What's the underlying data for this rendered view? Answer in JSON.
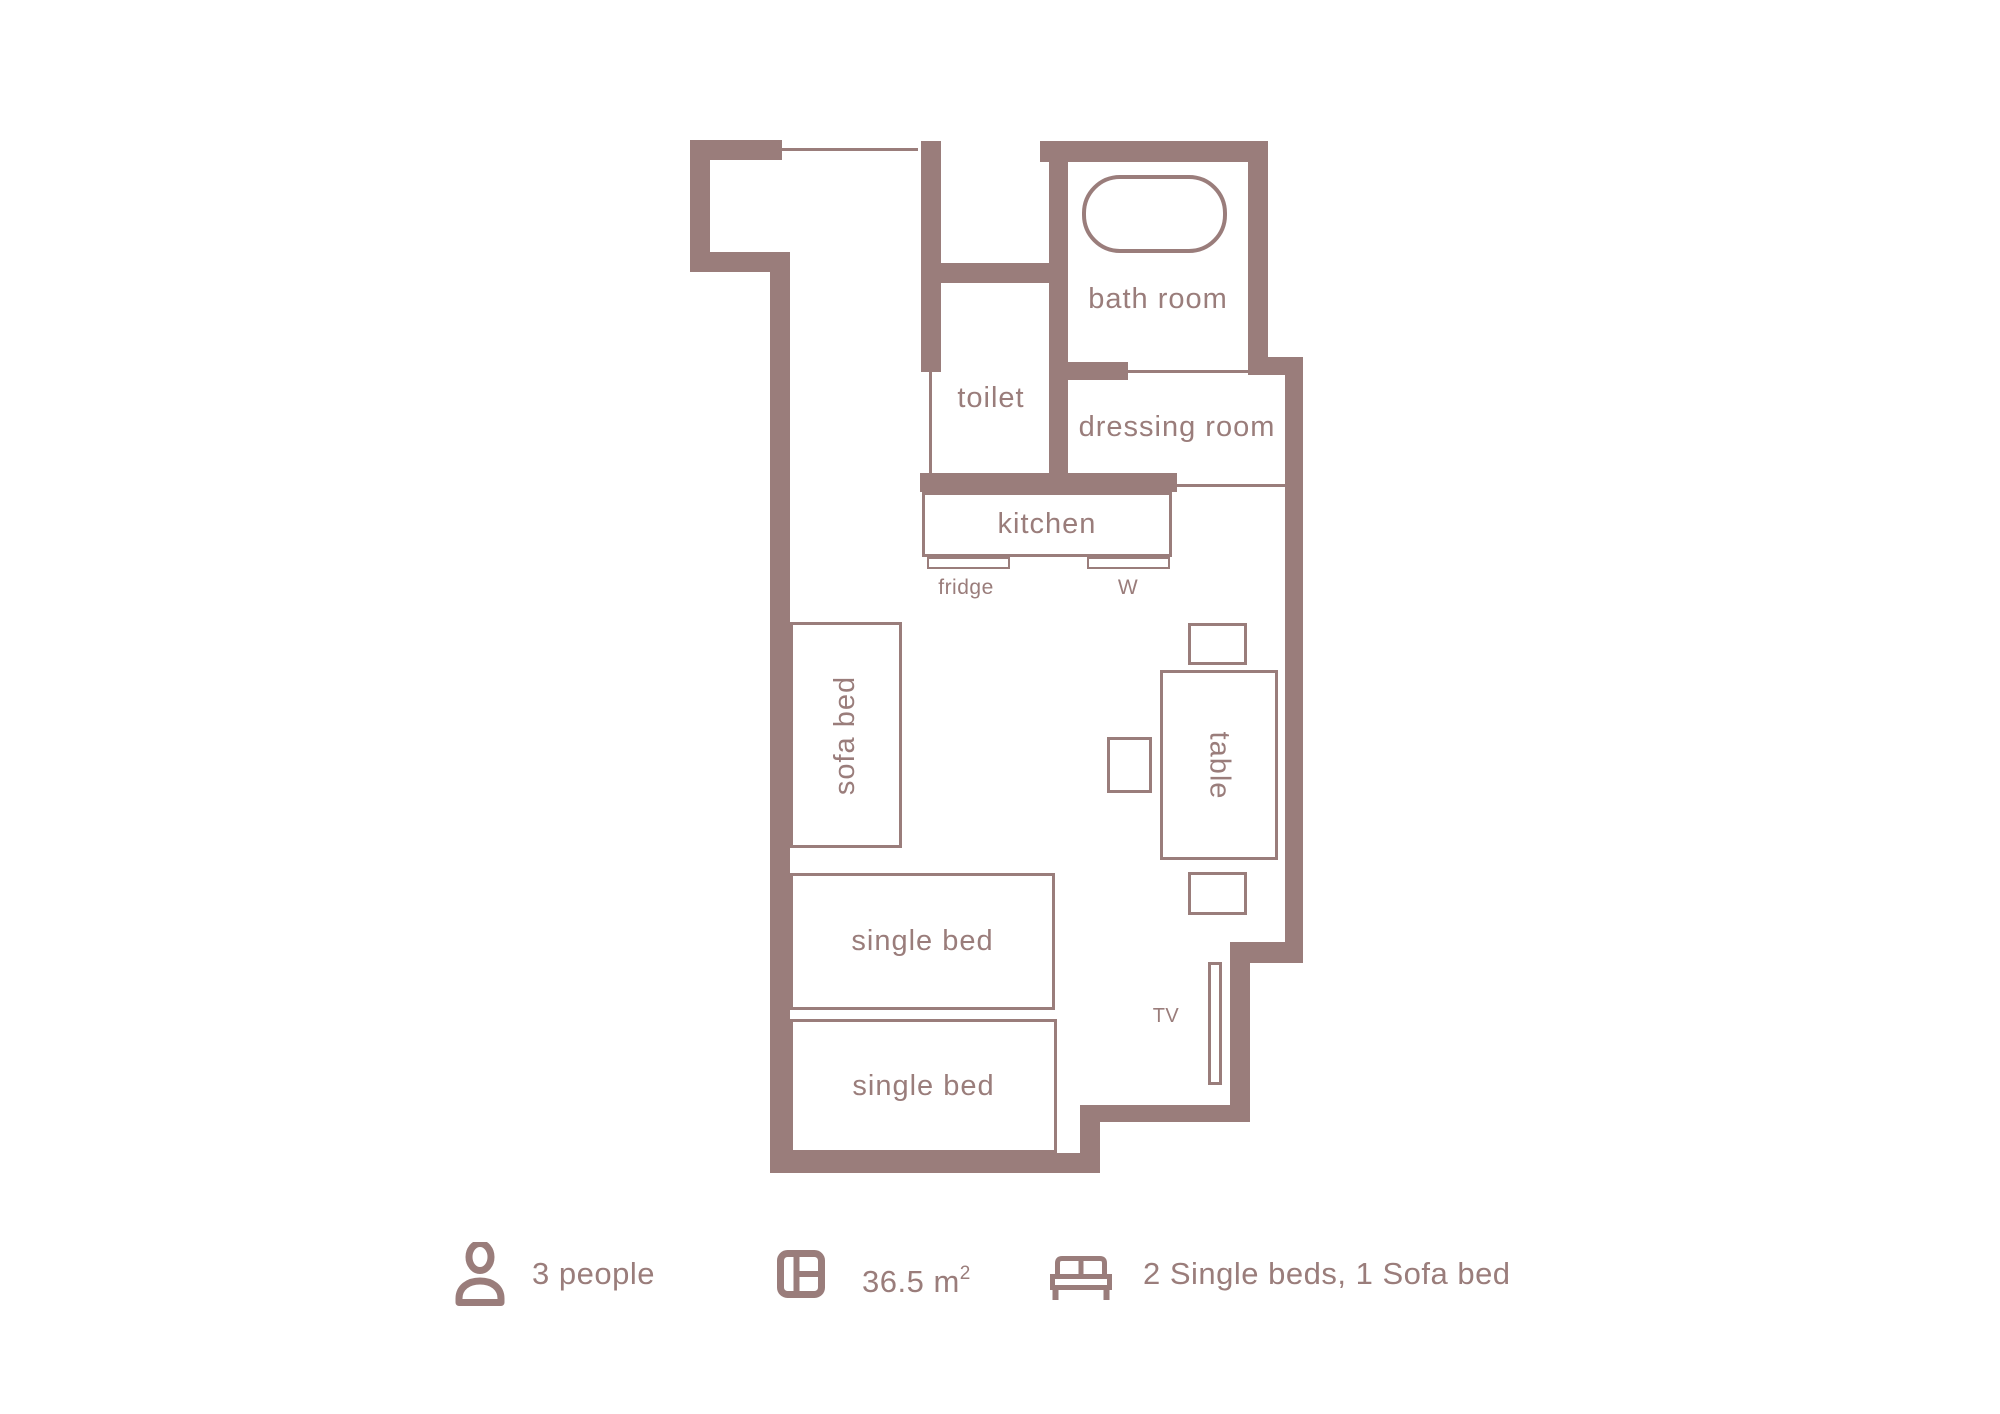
{
  "colors": {
    "wall": "#9a7d7b",
    "text": "#9a7d7b",
    "background": "#ffffff"
  },
  "rooms": {
    "bathroom": {
      "label": "bath room"
    },
    "toilet": {
      "label": "toilet"
    },
    "dressing_room": {
      "label": "dressing room"
    },
    "kitchen": {
      "label": "kitchen"
    }
  },
  "furniture": {
    "fridge": {
      "label": "fridge"
    },
    "washing_machine": {
      "label": "W"
    },
    "sofa_bed": {
      "label": "sofa bed"
    },
    "table": {
      "label": "table"
    },
    "single_bed_top": {
      "label": "single bed"
    },
    "single_bed_bottom": {
      "label": "single bed"
    },
    "tv": {
      "label": "TV"
    }
  },
  "legend": {
    "capacity": {
      "icon": "person-icon",
      "label": "3 people"
    },
    "area": {
      "icon": "floor-area-icon",
      "value": "36.5 m",
      "superscript": "2"
    },
    "sleeping": {
      "icon": "bed-icon",
      "label": "2 Single beds, 1 Sofa bed"
    }
  }
}
